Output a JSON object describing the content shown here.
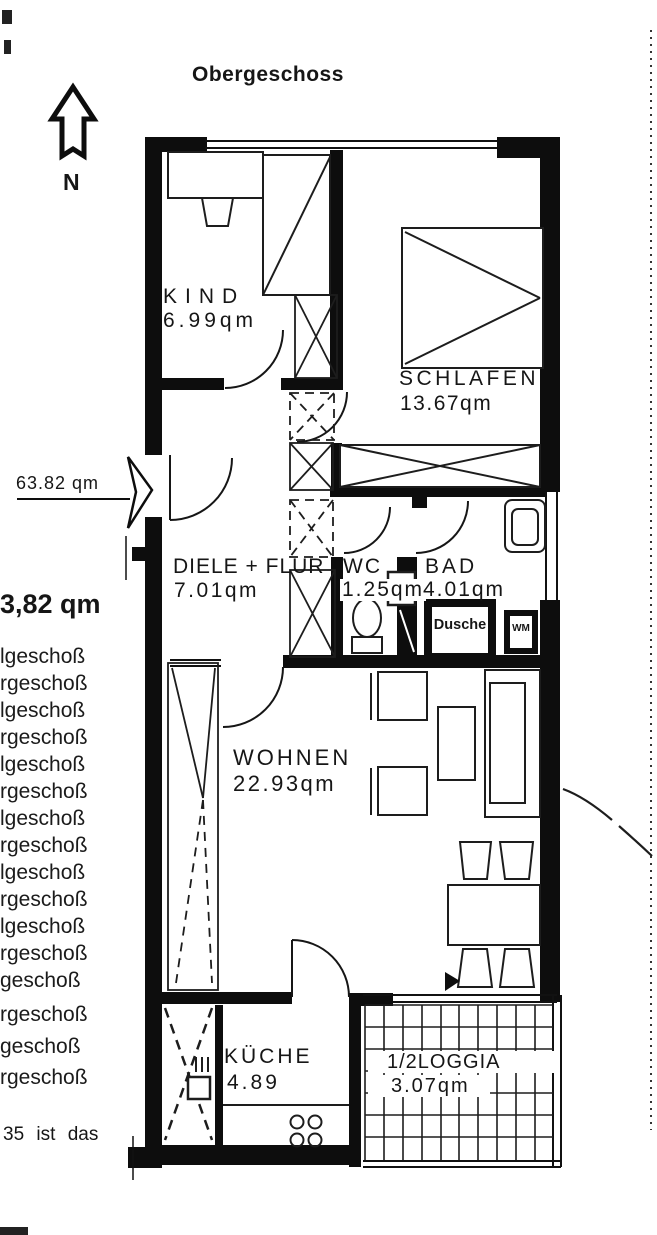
{
  "title": "Obergeschoss",
  "compass": {
    "north_label": "N"
  },
  "entrance": {
    "area_label": "63.82 qm"
  },
  "rooms": {
    "kind": {
      "name": "KIND",
      "area": "6.99qm"
    },
    "schlafen": {
      "name": "SCHLAFEN",
      "area": "13.67qm"
    },
    "diele": {
      "name": "DIELE + FLUR",
      "area": "7.01qm"
    },
    "wc": {
      "name": "WC",
      "area": "1.25qm"
    },
    "bad": {
      "name": "BAD",
      "area": "4.01qm"
    },
    "wohnen": {
      "name": "WOHNEN",
      "area": "22.93qm"
    },
    "kueche": {
      "name": "KÜCHE",
      "area": "4.89"
    },
    "loggia": {
      "name": "1/2LOGGIA",
      "area": "3.07qm"
    }
  },
  "fixtures": {
    "shower": "Dusche",
    "washing_machine": "WM"
  },
  "margin_text": {
    "bold_area": "3,82 qm",
    "floor_lines": [
      "lgeschoß",
      "rgeschoß",
      "lgeschoß",
      "rgeschoß",
      "lgeschoß",
      "rgeschoß",
      "lgeschoß",
      "rgeschoß",
      "lgeschoß",
      "rgeschoß",
      "lgeschoß",
      "rgeschoß",
      "geschoß",
      "rgeschoß",
      "geschoß",
      "rgeschoß"
    ],
    "bottom_note": "35 ist das"
  },
  "colors": {
    "ink": "#111111",
    "paper": "#ffffff"
  }
}
